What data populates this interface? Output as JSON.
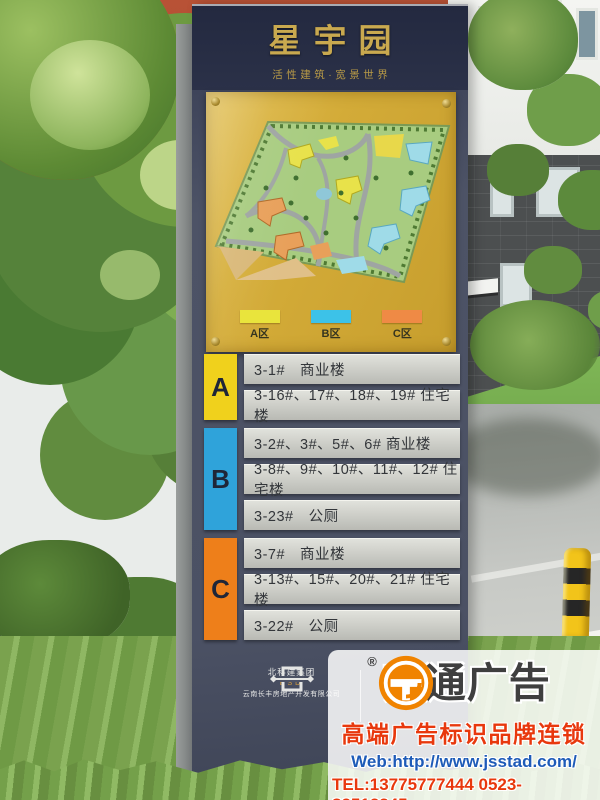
{
  "sign": {
    "title": "星宇园",
    "subtitle": "活性建筑·宽景世界",
    "map_legend": [
      {
        "label": "A区",
        "color": "#e9e43c"
      },
      {
        "label": "B区",
        "color": "#3cc2e8"
      },
      {
        "label": "C区",
        "color": "#ef8a45"
      }
    ],
    "directory": [
      {
        "section": "A",
        "color": "#f0d11c",
        "rows": [
          "3-1#　商业楼",
          "3-16#、17#、18#、19#  住宅楼"
        ]
      },
      {
        "section": "B",
        "color": "#2fa3da",
        "rows": [
          "3-2#、3#、5#、6#  商业楼",
          "3-8#、9#、10#、11#、12#  住宅楼",
          "3-23#　公厕"
        ]
      },
      {
        "section": "C",
        "color": "#ee7f1a",
        "rows": [
          "3-7#　商业楼",
          "3-13#、15#、20#、21#  住宅楼",
          "3-22#　公厕"
        ]
      }
    ],
    "developer": {
      "name": "北科建集团",
      "abbr": "BSD",
      "company": "云南长丰房地产开发有限公司"
    }
  },
  "watermark": {
    "registered_mark": "®",
    "brand": "苏通广告",
    "tagline": "高端广告标识品牌连锁",
    "web": "Web:http://www.jsstad.com/",
    "tel": "TEL:13775777444  0523-82512345"
  },
  "colors": {
    "sign_face": "#4d5366",
    "sign_header": "#272d40",
    "gold_text": "#c9a94f",
    "panel_yellow": "#d3ab38",
    "watermark_orange": "#f08300",
    "watermark_red": "#e8380d",
    "watermark_blue": "#1e5bb8"
  }
}
